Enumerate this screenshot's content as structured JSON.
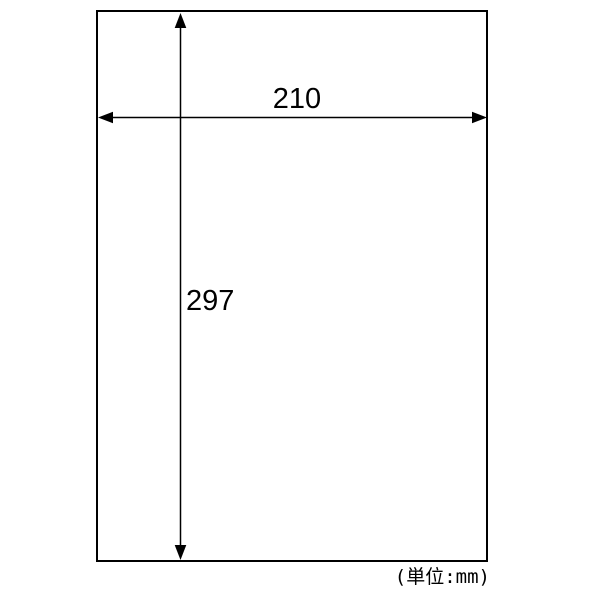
{
  "diagram": {
    "type": "dimension-drawing",
    "shape": "rectangle-paper-outline",
    "width_mm": "210",
    "height_mm": "297",
    "unit_note": "(単位:mm)"
  },
  "colors": {
    "line": "#000000",
    "background": "#ffffff"
  }
}
